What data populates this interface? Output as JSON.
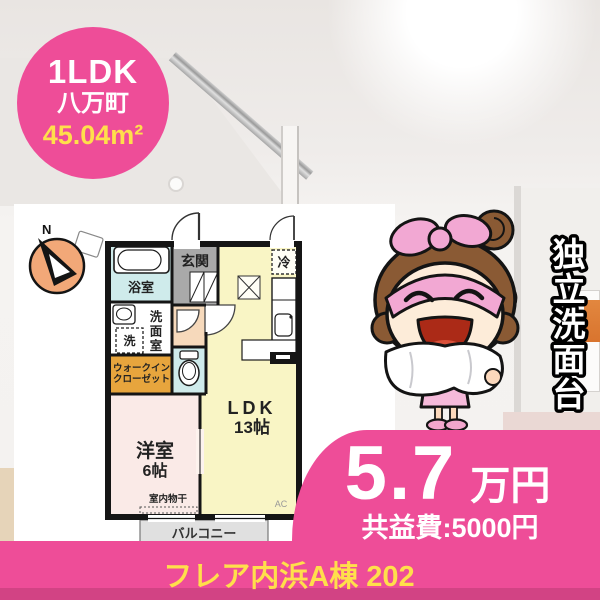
{
  "badge": {
    "layout": "1LDK",
    "town": "八万町",
    "area": "45.04m²"
  },
  "floorplan": {
    "compass_n": "N",
    "labels": {
      "genkan": "玄関",
      "bath": "浴室",
      "washroom": [
        "洗",
        "面",
        "室"
      ],
      "washer": "洗",
      "wic": [
        "ウォークイン",
        "クローゼット"
      ],
      "western": "洋室",
      "western_size": "6帖",
      "drying": "室内物干",
      "ldk": "LDK",
      "ldk_size": "13帖",
      "fridge": "冷",
      "balcony": "バルコニー",
      "ac": "AC"
    }
  },
  "feature": {
    "text": "独立洗面台",
    "chars": [
      "独",
      "立",
      "洗",
      "面",
      "台"
    ]
  },
  "price": {
    "amount": "5.7",
    "unit": "万円",
    "fee": "共益費:5000円"
  },
  "property": {
    "name": "フレア内浜A棟 202"
  },
  "colors": {
    "accent_pink": "#ee4d98",
    "accent_yellow": "#ffdf4b"
  }
}
